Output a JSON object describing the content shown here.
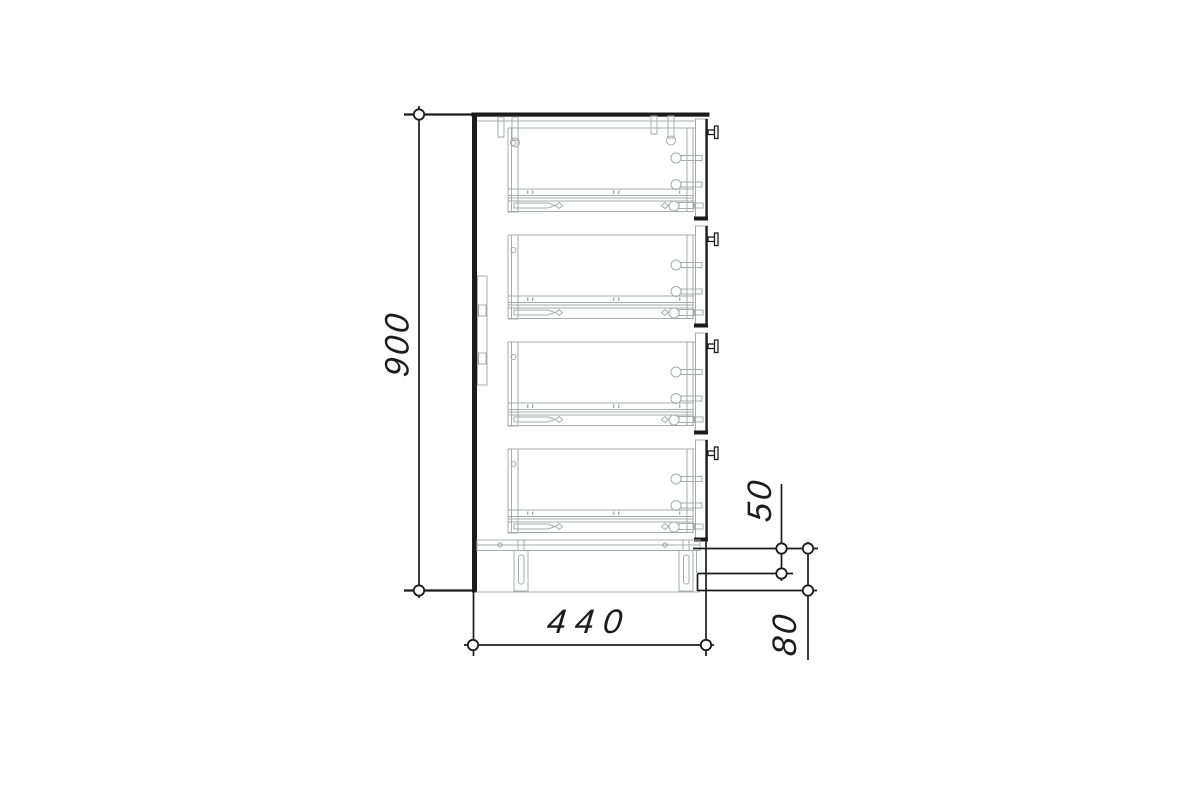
{
  "drawing": {
    "type": "technical-drawing",
    "subject": "four-drawer cabinet, side section view with telescopic slides and mounting hardware",
    "drawer_count": 4,
    "background": "#ffffff"
  },
  "dimensions": {
    "height": {
      "label": "900"
    },
    "width": {
      "label": "440"
    },
    "drawer_slide_offset": {
      "label": "50"
    },
    "plinth_height": {
      "label": "80"
    }
  },
  "colors": {
    "primary_line": "#1c1c1c",
    "secondary_line": "#a7abad"
  }
}
